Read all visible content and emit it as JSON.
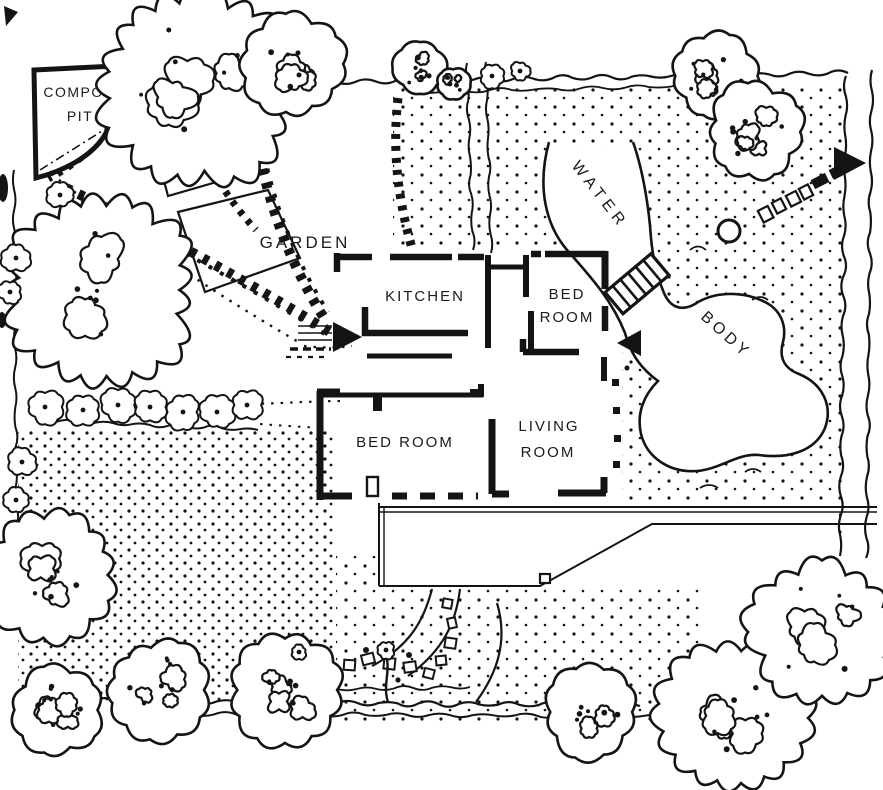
{
  "plan": {
    "labels": {
      "compost_line1": "COMPOST",
      "compost_line2": "PIT",
      "garden": "GARDEN",
      "kitchen": "KITCHEN",
      "bed_upper_1": "BED",
      "bed_upper_2": "ROOM",
      "bed_lower": "BED ROOM",
      "living_1": "LIVING",
      "living_2": "ROOM",
      "water_1": "WATER",
      "water_2": "BODY"
    },
    "colors": {
      "ink": "#141414",
      "paper": "#ffffff"
    }
  }
}
